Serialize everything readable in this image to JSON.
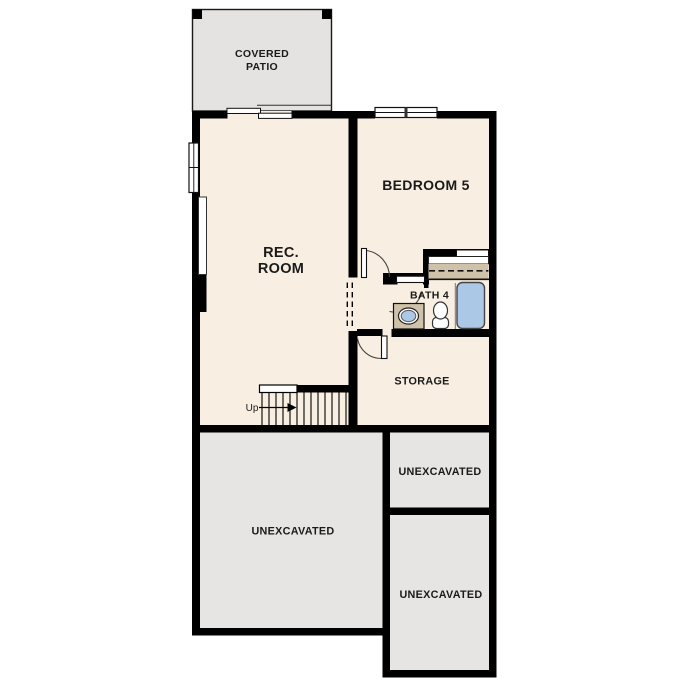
{
  "floor_plan": {
    "title": "basement floor plan",
    "rooms": {
      "covered_patio": {
        "label_line1": "COVERED",
        "label_line2": "PATIO"
      },
      "rec_room": {
        "label_line1": "REC.",
        "label_line2": "ROOM"
      },
      "bedroom_5": {
        "label": "BEDROOM 5"
      },
      "bath_4": {
        "label": "BATH 4"
      },
      "storage": {
        "label": "STORAGE"
      },
      "unexcavated_left": {
        "label": "UNEXCAVATED"
      },
      "unexcavated_top_right": {
        "label": "UNEXCAVATED"
      },
      "unexcavated_bottom_right": {
        "label": "UNEXCAVATED"
      }
    },
    "stairs": {
      "direction_label": "Up"
    },
    "fixtures": {
      "bathtub": "bathtub",
      "toilet": "toilet",
      "sink": "vanity-sink",
      "closet_shelf": "closet-shelf-and-rod",
      "sliding_door": "sliding-glass-door",
      "window_bedroom": "double-window",
      "window_rec_room": "double-hung-window",
      "doors": "swing-doors",
      "opening": "dashed-cased-opening"
    },
    "colors": {
      "wall": "#000000",
      "floor": "#f8efe2",
      "patio": "#e4e3e1",
      "unexcavated": "#e6e5e3",
      "cabinet": "#cfc2a8",
      "fixture_blue": "#abc8e6",
      "text": "#1a1a1a"
    }
  }
}
